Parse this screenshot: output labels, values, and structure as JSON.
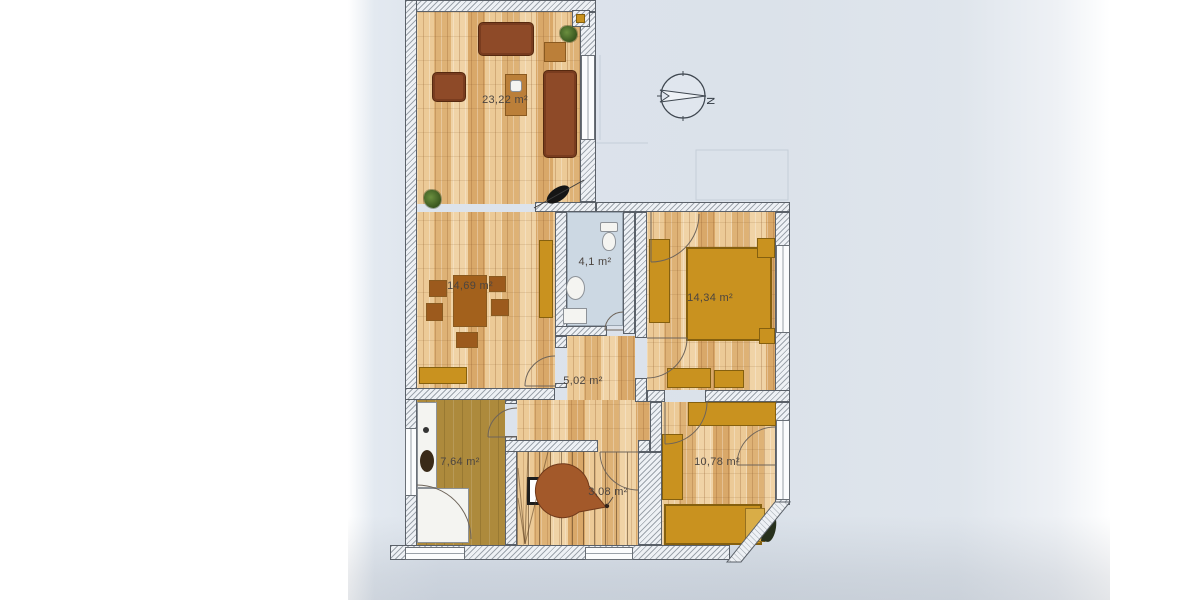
{
  "document": {
    "kind": "photographed apartment floor plan",
    "compass": {
      "north_label": "N"
    }
  },
  "rooms": [
    {
      "name": "living-room",
      "area_label": "23,22 m²"
    },
    {
      "name": "dining-room",
      "area_label": "14,69 m²"
    },
    {
      "name": "bathroom",
      "area_label": "4,1 m²"
    },
    {
      "name": "bedroom-large",
      "area_label": "14,34 m²"
    },
    {
      "name": "hallway",
      "area_label": "5,02 m²"
    },
    {
      "name": "kitchen",
      "area_label": "7,64 m²"
    },
    {
      "name": "staircase",
      "area_label": "3,08 m²"
    },
    {
      "name": "bedroom-small",
      "area_label": "10,78 m²"
    }
  ],
  "colors": {
    "paper": "#dbe2ea",
    "wood_floor": "#e8c28c",
    "kitchen_floor": "#ad8a3c",
    "bath_floor": "#ccd8e3",
    "furniture_amber": "#c9921f",
    "furniture_brown": "#8e4a28",
    "wall_outline": "#5a6068"
  }
}
